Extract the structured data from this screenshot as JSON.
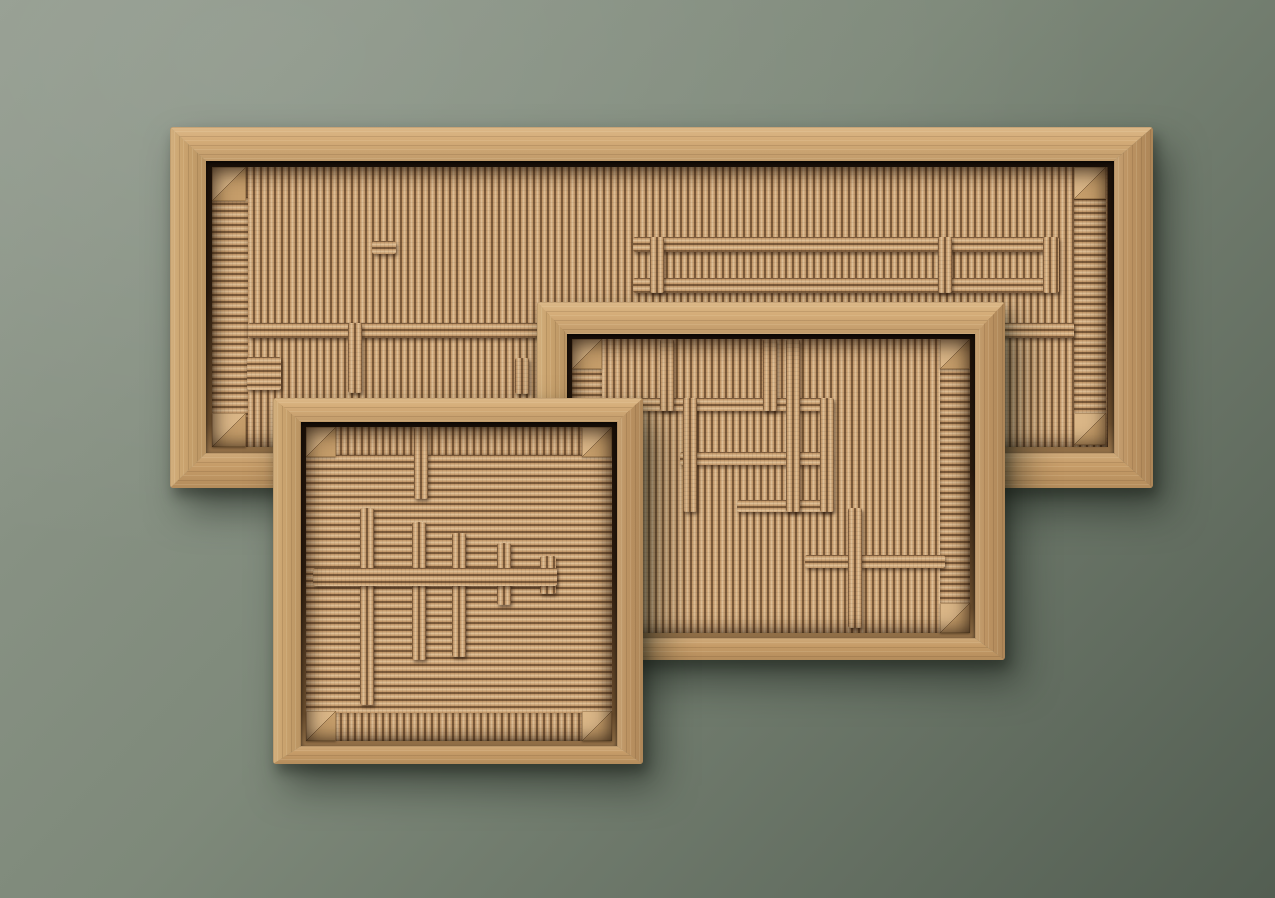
{
  "scene": {
    "background": {
      "top_left": "#929b8e",
      "middle": "#7e897a",
      "bottom_right": "#535e52"
    },
    "palette": {
      "cord_light": "#debe95",
      "cord_mid": "#c49a6c",
      "cord_dark": "#7b5a3a",
      "wood_top": "#d5ad79",
      "wood_left": "#cba46f",
      "wood_right": "#bd9463",
      "wood_bottom": "#c69c68",
      "block_light": "#dab687",
      "block_dark": "#c59d6a"
    },
    "panels": [
      {
        "name": "large-horizontal-weaving",
        "rect": [
          170,
          127,
          983,
          361
        ],
        "border": [
          34,
          39,
          35,
          36
        ],
        "lip": 6,
        "field": "v",
        "blocks": [
          [
            0,
            0,
            34,
            34
          ],
          [
            862,
            0,
            32,
            32
          ],
          [
            0,
            246,
            34,
            34
          ],
          [
            862,
            246,
            32,
            32
          ]
        ],
        "selvages": [
          {
            "rect": [
              0,
              30,
              36,
              220
            ],
            "tx": "h"
          },
          {
            "rect": [
              862,
              32,
              32,
              216
            ],
            "tx": "h"
          }
        ],
        "bars": [
          {
            "rect": [
              36,
              156,
              826,
              15
            ],
            "tx": "h"
          },
          {
            "rect": [
              421,
              70,
              412,
              15
            ],
            "tx": "h"
          },
          {
            "rect": [
              421,
              111,
              412,
              15
            ],
            "tx": "h"
          },
          {
            "rect": [
              831,
              70,
              16,
              56
            ],
            "tx": "v"
          },
          {
            "rect": [
              438,
              70,
              14,
              56
            ],
            "tx": "v"
          },
          {
            "rect": [
              726,
              70,
              14,
              56
            ],
            "tx": "v"
          },
          {
            "rect": [
              160,
              74,
              24,
              13
            ],
            "tx": "h"
          },
          {
            "rect": [
              136,
              156,
              14,
              70
            ],
            "tx": "v"
          },
          {
            "rect": [
              303,
              191,
              14,
              36
            ],
            "tx": "v"
          },
          {
            "rect": [
              35,
              190,
              34,
              33
            ],
            "tx": "h"
          }
        ]
      },
      {
        "name": "medium-rectangular-weaving",
        "rect": [
          537,
          302,
          468,
          358
        ],
        "border": [
          32,
          30,
          22,
          30
        ],
        "lip": 5,
        "field": "v",
        "blocks": [
          [
            0,
            0,
            30,
            30
          ],
          [
            368,
            0,
            30,
            30
          ],
          [
            0,
            264,
            30,
            30
          ],
          [
            368,
            264,
            30,
            30
          ]
        ],
        "selvages": [
          {
            "rect": [
              0,
              28,
              30,
              238
            ],
            "tx": "h"
          },
          {
            "rect": [
              368,
              28,
              30,
              238
            ],
            "tx": "h"
          }
        ],
        "bars": [
          {
            "rect": [
              23,
              59,
              236,
              13
            ],
            "tx": "h"
          },
          {
            "rect": [
              108,
              113,
              151,
              13
            ],
            "tx": "h"
          },
          {
            "rect": [
              165,
              161,
              94,
              12
            ],
            "tx": "h"
          },
          {
            "rect": [
              233,
              216,
              140,
              13
            ],
            "tx": "h"
          },
          {
            "rect": [
              88,
              0,
              14,
              72
            ],
            "tx": "v"
          },
          {
            "rect": [
              191,
              0,
              14,
              72
            ],
            "tx": "v"
          },
          {
            "rect": [
              214,
              0,
              14,
              173
            ],
            "tx": "v"
          },
          {
            "rect": [
              111,
              59,
              14,
              114
            ],
            "tx": "v"
          },
          {
            "rect": [
              248,
              59,
              14,
              114
            ],
            "tx": "v"
          },
          {
            "rect": [
              276,
              169,
              14,
              120
            ],
            "tx": "v"
          }
        ]
      },
      {
        "name": "small-square-weaving",
        "rect": [
          273,
          398,
          370,
          366
        ],
        "border": [
          24,
          26,
          18,
          28
        ],
        "lip": 5,
        "field": "h",
        "blocks": [
          [
            0,
            0,
            30,
            30
          ],
          [
            276,
            0,
            30,
            30
          ],
          [
            0,
            284,
            30,
            30
          ],
          [
            276,
            284,
            30,
            30
          ]
        ],
        "selvages": [
          {
            "rect": [
              28,
              0,
              250,
              28
            ],
            "tx": "v"
          },
          {
            "rect": [
              28,
              286,
              250,
              28
            ],
            "tx": "v"
          }
        ],
        "bars": [
          {
            "rect": [
              108,
              0,
              14,
              72
            ],
            "tx": "v"
          },
          {
            "rect": [
              54,
              81,
              14,
              197
            ],
            "tx": "v"
          },
          {
            "rect": [
              106,
              95,
              14,
              138
            ],
            "tx": "v"
          },
          {
            "rect": [
              146,
              106,
              14,
              124
            ],
            "tx": "v"
          },
          {
            "rect": [
              191,
              116,
              14,
              62
            ],
            "tx": "v"
          },
          {
            "rect": [
              234,
              129,
              16,
              38
            ],
            "tx": "v"
          },
          {
            "rect": [
              7,
              141,
              244,
              18
            ],
            "tx": "h"
          }
        ]
      }
    ]
  }
}
